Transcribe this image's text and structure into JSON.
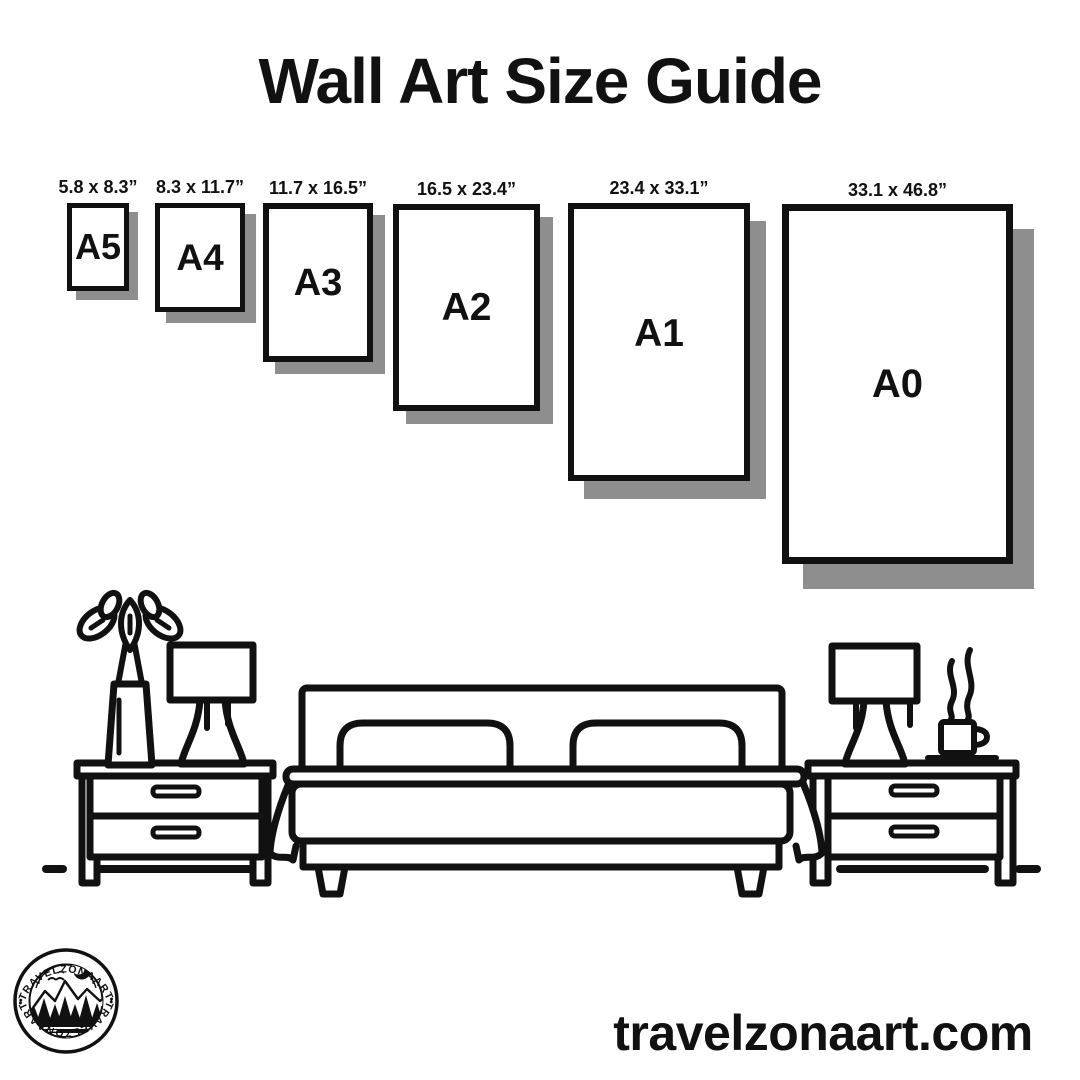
{
  "title": "Wall Art Size Guide",
  "frames": [
    {
      "id": "A5",
      "dimensions": "5.8 x 8.3”",
      "label": "A5"
    },
    {
      "id": "A4",
      "dimensions": "8.3 x 11.7”",
      "label": "A4"
    },
    {
      "id": "A3",
      "dimensions": "11.7 x 16.5”",
      "label": "A3"
    },
    {
      "id": "A2",
      "dimensions": "16.5 x 23.4”",
      "label": "A2"
    },
    {
      "id": "A1",
      "dimensions": "23.4 x 33.1”",
      "label": "A1"
    },
    {
      "id": "A0",
      "dimensions": "33.1 x 46.8”",
      "label": "A0"
    }
  ],
  "logo": {
    "arc_text_top": "•TRAVELZONAART•",
    "arc_text_bottom": "•TRAVELZONAART•"
  },
  "footer": {
    "website": "travelzonaart.com"
  },
  "colors": {
    "ink": "#111111",
    "frame_shadow": "#8e8e8e",
    "background": "#ffffff"
  }
}
